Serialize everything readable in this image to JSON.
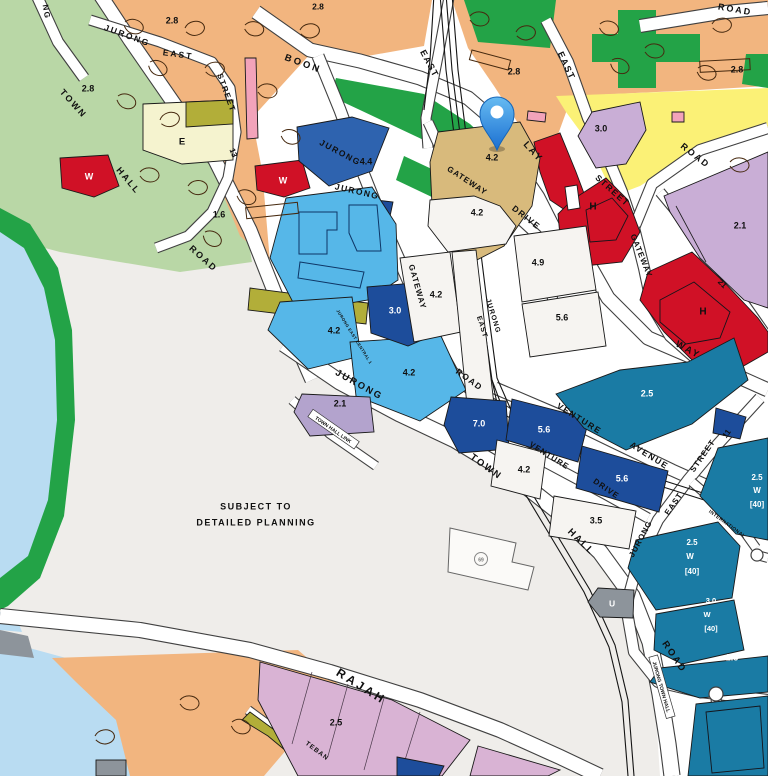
{
  "map": {
    "note": {
      "line1": "SUBJECT TO",
      "line2": "DETAILED PLANNING"
    },
    "pin": {
      "name": "location-pin"
    },
    "colors": {
      "residential_orange": "#f2b57f",
      "park_pale_green": "#b9d7a6",
      "open_green": "#23a347",
      "water_blue": "#b9dcf2",
      "reserve_gray": "#efedea",
      "commercial_lightblue": "#56b7e8",
      "commercial_navy": "#1d4d9b",
      "commercial_royal": "#2e63af",
      "business_teal": "#1a7ba4",
      "red_zone": "#d01126",
      "yellow_zone": "#fbf176",
      "purple_zone": "#c9aed6",
      "lilac_zone": "#b3a3cd",
      "mauve_zone": "#d9b3d4",
      "olive_zone": "#b2ae39",
      "cream_zone": "#f5f3cf",
      "tan_zone": "#d8ba7c",
      "pink_building": "#f2a3ba",
      "utility_gray": "#8d949b",
      "pin_blue": "#2f8de4"
    },
    "labels": [
      {
        "n": "road-label-ng",
        "t": "NG",
        "x": 46,
        "y": 12,
        "r": 80,
        "s": 8,
        "ls": 1.5
      },
      {
        "n": "road-label-jurong-east-st13-jurong",
        "t": "JURONG",
        "x": 127,
        "y": 36,
        "r": 20,
        "s": 8.5,
        "ls": 2
      },
      {
        "n": "road-label-jurong-east-st13-east",
        "t": "EAST",
        "x": 178,
        "y": 55,
        "r": 8,
        "s": 8.5,
        "ls": 2
      },
      {
        "n": "road-label-jurong-east-st13-street",
        "t": "STREET",
        "x": 226,
        "y": 93,
        "r": 70,
        "s": 8,
        "ls": 1.5
      },
      {
        "n": "road-label-jurong-east-st13-13",
        "t": "13",
        "x": 233,
        "y": 153,
        "r": 68,
        "s": 8
      },
      {
        "n": "road-label-town-hall-w-town",
        "t": "TOWN",
        "x": 73,
        "y": 104,
        "r": 48,
        "s": 9,
        "ls": 2
      },
      {
        "n": "road-label-town-hall-w-hall",
        "t": "HALL",
        "x": 128,
        "y": 181,
        "r": 50,
        "s": 9,
        "ls": 2
      },
      {
        "n": "road-label-town-hall-w-road",
        "t": "ROAD",
        "x": 203,
        "y": 259,
        "r": 42,
        "s": 9,
        "ls": 2
      },
      {
        "n": "road-label-boon",
        "t": "BOON",
        "x": 303,
        "y": 64,
        "r": 20,
        "s": 9.5,
        "ls": 2.5
      },
      {
        "n": "road-label-lay",
        "t": "LAY",
        "x": 533,
        "y": 152,
        "r": 48,
        "s": 9.5,
        "ls": 2
      },
      {
        "n": "road-label-way",
        "t": "WAY",
        "x": 688,
        "y": 350,
        "r": 28,
        "s": 9.5,
        "ls": 2
      },
      {
        "n": "road-label-road-topright",
        "t": "ROAD",
        "x": 735,
        "y": 10,
        "r": 10,
        "s": 9,
        "ls": 2
      },
      {
        "n": "road-label-east-top",
        "t": "EAST",
        "x": 429,
        "y": 64,
        "r": 62,
        "s": 9,
        "ls": 1.5
      },
      {
        "n": "road-label-east-street-east",
        "t": "EAST",
        "x": 566,
        "y": 66,
        "r": 65,
        "s": 9,
        "ls": 1.5
      },
      {
        "n": "road-label-east-street-street",
        "t": "STREET",
        "x": 612,
        "y": 191,
        "r": 42,
        "s": 8.5,
        "ls": 1.5
      },
      {
        "n": "road-label-road-yellow",
        "t": "ROAD",
        "x": 695,
        "y": 156,
        "r": 38,
        "s": 9,
        "ls": 2
      },
      {
        "n": "road-label-gateway-east",
        "t": "GATEWAY",
        "x": 641,
        "y": 256,
        "r": 68,
        "s": 8,
        "ls": 1
      },
      {
        "n": "road-label-street-21",
        "t": "21",
        "x": 722,
        "y": 284,
        "r": 45,
        "s": 8
      },
      {
        "n": "road-label-jurong-gw-jurong",
        "t": "JURONG",
        "x": 340,
        "y": 153,
        "r": 28,
        "s": 8.5,
        "ls": 1.5
      },
      {
        "n": "road-label-jurong-gw2-jurong",
        "t": "JURONG",
        "x": 357,
        "y": 192,
        "r": 13,
        "s": 8.5,
        "ls": 1.5
      },
      {
        "n": "road-label-gateway-drive-gateway",
        "t": "GATEWAY",
        "x": 467,
        "y": 181,
        "r": 33,
        "s": 8,
        "ls": 1
      },
      {
        "n": "road-label-gateway-drive-drive",
        "t": "DRIVE",
        "x": 526,
        "y": 218,
        "r": 38,
        "s": 8.5,
        "ls": 1.5
      },
      {
        "n": "road-label-jurong-gw-gateway",
        "t": "GATEWAY",
        "x": 417,
        "y": 287,
        "r": 74,
        "s": 8,
        "ls": 1
      },
      {
        "n": "road-label-jurong-gw-road",
        "t": "ROAD",
        "x": 469,
        "y": 380,
        "r": 36,
        "s": 8.5,
        "ls": 1.5
      },
      {
        "n": "road-label-station-jurong",
        "t": "JURONG",
        "x": 493,
        "y": 316,
        "r": 73,
        "s": 7,
        "ls": 1
      },
      {
        "n": "road-label-station-east",
        "t": "EAST",
        "x": 482,
        "y": 327,
        "r": 73,
        "s": 7,
        "ls": 1
      },
      {
        "n": "road-label-jurong-east-central",
        "t": "JURONG EAST CENTRAL 1",
        "x": 354,
        "y": 337,
        "r": 58,
        "s": 4.2,
        "ls": 0.4
      },
      {
        "n": "road-label-venture-ave-venture",
        "t": "VENTURE",
        "x": 579,
        "y": 419,
        "r": 32,
        "s": 8.5,
        "ls": 1.5
      },
      {
        "n": "road-label-venture-ave-avenue",
        "t": "AVENUE",
        "x": 649,
        "y": 456,
        "r": 32,
        "s": 8.5,
        "ls": 1.5
      },
      {
        "n": "road-label-venture-dr-venture",
        "t": "VENTURE",
        "x": 549,
        "y": 456,
        "r": 32,
        "s": 8,
        "ls": 1
      },
      {
        "n": "road-label-venture-dr-drive",
        "t": "DRIVE",
        "x": 606,
        "y": 489,
        "r": 34,
        "s": 8,
        "ls": 1
      },
      {
        "n": "road-label-st11-jurong",
        "t": "JURONG",
        "x": 641,
        "y": 539,
        "r": -62,
        "s": 8,
        "ls": 1
      },
      {
        "n": "road-label-st11-east",
        "t": "EAST",
        "x": 674,
        "y": 504,
        "r": -55,
        "s": 8,
        "ls": 1
      },
      {
        "n": "road-label-st11-street",
        "t": "STREET",
        "x": 703,
        "y": 456,
        "r": -55,
        "s": 8,
        "ls": 1
      },
      {
        "n": "road-label-st11-11",
        "t": "11",
        "x": 727,
        "y": 434,
        "r": -55,
        "s": 8
      },
      {
        "n": "road-label-international",
        "t": "INTERNATIONAL",
        "x": 727,
        "y": 524,
        "r": 36,
        "s": 4.8,
        "ls": 0.4
      },
      {
        "n": "road-label-jth-town",
        "t": "TOWN",
        "x": 486,
        "y": 467,
        "r": 36,
        "s": 9.5,
        "ls": 2
      },
      {
        "n": "road-label-jth-hall",
        "t": "HALL",
        "x": 581,
        "y": 542,
        "r": 44,
        "s": 9.5,
        "ls": 2
      },
      {
        "n": "road-label-jth-road",
        "t": "ROAD",
        "x": 674,
        "y": 657,
        "r": 56,
        "s": 9.5,
        "ls": 2
      },
      {
        "n": "road-label-jth-jurong",
        "t": "JURONG",
        "x": 359,
        "y": 385,
        "r": 29,
        "s": 9.5,
        "ls": 2
      },
      {
        "n": "road-label-town-hall-link",
        "t": "TOWN HALL LINK",
        "x": 333,
        "y": 430,
        "r": 35,
        "s": 5,
        "box": true
      },
      {
        "n": "road-label-jurong-town-hall-banner",
        "t": "JURONG TOWN HALL",
        "x": 661,
        "y": 687,
        "r": 74,
        "s": 5,
        "box": true
      },
      {
        "n": "road-label-rajah",
        "t": "RAJAH",
        "x": 361,
        "y": 687,
        "r": 32,
        "s": 12,
        "ls": 3
      },
      {
        "n": "road-label-teban",
        "t": "TEBAN",
        "x": 317,
        "y": 751,
        "r": 37,
        "s": 6.5,
        "ls": 1
      },
      {
        "n": "plot-ratio-2-8-a",
        "t": "2.8",
        "x": 318,
        "y": 7,
        "s": 8.5
      },
      {
        "n": "plot-ratio-2-8-b",
        "t": "2.8",
        "x": 172,
        "y": 21,
        "s": 9
      },
      {
        "n": "plot-ratio-2-8-c",
        "t": "2.8",
        "x": 88,
        "y": 89,
        "s": 9
      },
      {
        "n": "plot-ratio-2-8-d",
        "t": "2.8",
        "x": 514,
        "y": 72,
        "s": 9
      },
      {
        "n": "plot-ratio-2-8-e",
        "t": "2.8",
        "x": 737,
        "y": 70,
        "s": 9
      },
      {
        "n": "plot-ratio-1-6",
        "t": "1.6",
        "x": 219,
        "y": 215,
        "s": 9
      },
      {
        "n": "plot-label-e",
        "t": "E",
        "x": 182,
        "y": 142,
        "s": 9.5
      },
      {
        "n": "plot-label-w-a",
        "t": "W",
        "x": 89,
        "y": 177,
        "s": 9,
        "c": "#ffffff"
      },
      {
        "n": "plot-label-w-b",
        "t": "W",
        "x": 283,
        "y": 181,
        "s": 9,
        "c": "#ffffff"
      },
      {
        "n": "plot-ratio-4-4",
        "t": "4.4",
        "x": 366,
        "y": 162,
        "s": 9
      },
      {
        "n": "plot-ratio-4-2-pin",
        "t": "4.2",
        "x": 492,
        "y": 158,
        "s": 9
      },
      {
        "n": "plot-ratio-3-0-purple",
        "t": "3.0",
        "x": 601,
        "y": 129,
        "s": 9
      },
      {
        "n": "plot-ratio-2-1-purple",
        "t": "2.1",
        "x": 740,
        "y": 226,
        "s": 9
      },
      {
        "n": "plot-label-h-a",
        "t": "H",
        "x": 593,
        "y": 207,
        "s": 10
      },
      {
        "n": "plot-label-h-b",
        "t": "H",
        "x": 703,
        "y": 312,
        "s": 10
      },
      {
        "n": "plot-ratio-2-5-teal",
        "t": "2.5",
        "x": 647,
        "y": 394,
        "s": 9,
        "c": "#ffffff"
      },
      {
        "n": "plot-ratio-4-2-white-a",
        "t": "4.2",
        "x": 477,
        "y": 213,
        "s": 9
      },
      {
        "n": "plot-ratio-4-9",
        "t": "4.9",
        "x": 538,
        "y": 263,
        "s": 9
      },
      {
        "n": "plot-ratio-5-6-white",
        "t": "5.6",
        "x": 562,
        "y": 318,
        "s": 9
      },
      {
        "n": "plot-ratio-4-2-white-b",
        "t": "4.2",
        "x": 436,
        "y": 295,
        "s": 9
      },
      {
        "n": "plot-ratio-4-2-blue-a",
        "t": "4.2",
        "x": 334,
        "y": 331,
        "s": 9
      },
      {
        "n": "plot-ratio-4-2-blue-b",
        "t": "4.2",
        "x": 409,
        "y": 373,
        "s": 9
      },
      {
        "n": "plot-ratio-3-0-navy",
        "t": "3.0",
        "x": 395,
        "y": 311,
        "s": 9,
        "c": "#ffffff"
      },
      {
        "n": "plot-ratio-2-1-lilac",
        "t": "2.1",
        "x": 340,
        "y": 404,
        "s": 9
      },
      {
        "n": "plot-ratio-7-0",
        "t": "7.0",
        "x": 479,
        "y": 424,
        "s": 9,
        "c": "#ffffff"
      },
      {
        "n": "plot-ratio-5-6-navy-a",
        "t": "5.6",
        "x": 544,
        "y": 430,
        "s": 9,
        "c": "#ffffff"
      },
      {
        "n": "plot-ratio-5-6-navy-b",
        "t": "5.6",
        "x": 622,
        "y": 479,
        "s": 9,
        "c": "#ffffff"
      },
      {
        "n": "plot-ratio-4-2-white-c",
        "t": "4.2",
        "x": 524,
        "y": 470,
        "s": 9
      },
      {
        "n": "plot-ratio-3-5",
        "t": "3.5",
        "x": 596,
        "y": 521,
        "s": 9
      },
      {
        "n": "plot-ratio-2-5-w40-right-1",
        "t": "2.5",
        "x": 757,
        "y": 478,
        "s": 8,
        "c": "#ffffff"
      },
      {
        "n": "plot-ratio-2-5-w40-right-2",
        "t": "W",
        "x": 757,
        "y": 491,
        "s": 8,
        "c": "#ffffff"
      },
      {
        "n": "plot-ratio-2-5-w40-right-3",
        "t": "[40]",
        "x": 757,
        "y": 505,
        "s": 8,
        "c": "#ffffff"
      },
      {
        "n": "plot-ratio-2-5-w40-mid-1",
        "t": "2.5",
        "x": 692,
        "y": 543,
        "s": 8,
        "c": "#ffffff"
      },
      {
        "n": "plot-ratio-2-5-w40-mid-2",
        "t": "W",
        "x": 690,
        "y": 557,
        "s": 8,
        "c": "#ffffff"
      },
      {
        "n": "plot-ratio-2-5-w40-mid-3",
        "t": "[40]",
        "x": 692,
        "y": 572,
        "s": 8,
        "c": "#ffffff"
      },
      {
        "n": "plot-ratio-3-0-w40-1",
        "t": "3.0",
        "x": 711,
        "y": 601,
        "s": 7.5,
        "c": "#ffffff"
      },
      {
        "n": "plot-ratio-3-0-w40-2",
        "t": "W",
        "x": 707,
        "y": 615,
        "s": 7.5,
        "c": "#ffffff"
      },
      {
        "n": "plot-ratio-3-0-w40-3",
        "t": "[40]",
        "x": 711,
        "y": 629,
        "s": 7.5,
        "c": "#ffffff"
      },
      {
        "n": "plot-ratio-2-5-teal-low",
        "t": "2.5",
        "x": 732,
        "y": 658,
        "s": 9,
        "c": "#ffffff"
      },
      {
        "n": "plot-ratio-2-5-mauve",
        "t": "2.5",
        "x": 336,
        "y": 723,
        "s": 9
      },
      {
        "n": "plot-label-u",
        "t": "U",
        "x": 612,
        "y": 604,
        "s": 8.5,
        "c": "#ffffff"
      },
      {
        "n": "building-number-69",
        "t": "69",
        "x": 481,
        "y": 560,
        "s": 5,
        "c": "#777777"
      },
      {
        "n": "subject-note-line1",
        "t": "SUBJECT TO",
        "x": 256,
        "y": 507,
        "s": 9,
        "ls": 1.5
      },
      {
        "n": "subject-note-line2",
        "t": "DETAILED PLANNING",
        "x": 256,
        "y": 523,
        "s": 9,
        "ls": 1.5
      }
    ]
  }
}
